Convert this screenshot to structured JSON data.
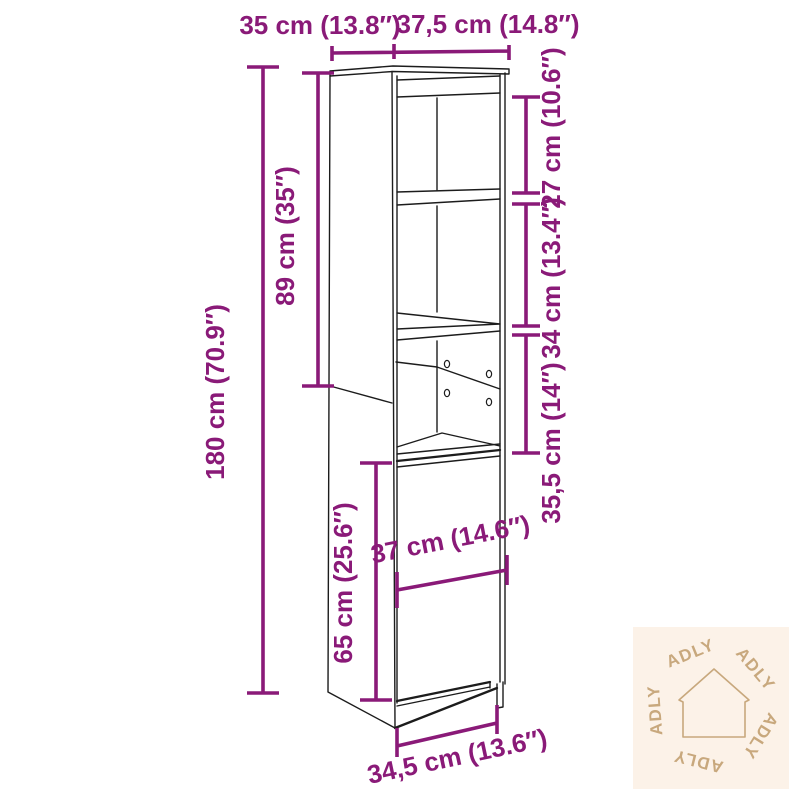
{
  "dimensions": {
    "top_depth": "35 cm (13.8″)",
    "top_width": "37,5 cm (14.8″)",
    "total_height": "180 cm (70.9″)",
    "upper_section_height": "89 cm (35″)",
    "top_shelf_height": "27 cm (10.6″)",
    "middle_shelf_height": "34 cm (13.4″)",
    "open_niche_height": "35,5 cm (14″)",
    "door_section_height": "65 cm (25.6″)",
    "door_width": "37 cm (14.6″)",
    "bottom_width": "34,5 cm (13.6″)"
  },
  "watermark": {
    "brand": "ADLY"
  },
  "colors": {
    "dimension_magenta": "#8A1A78",
    "outline_black": "#1c1c1c",
    "watermark_background": "#FCF2E8",
    "watermark_tan": "#C8A87D",
    "background": "#FFFFFF"
  }
}
